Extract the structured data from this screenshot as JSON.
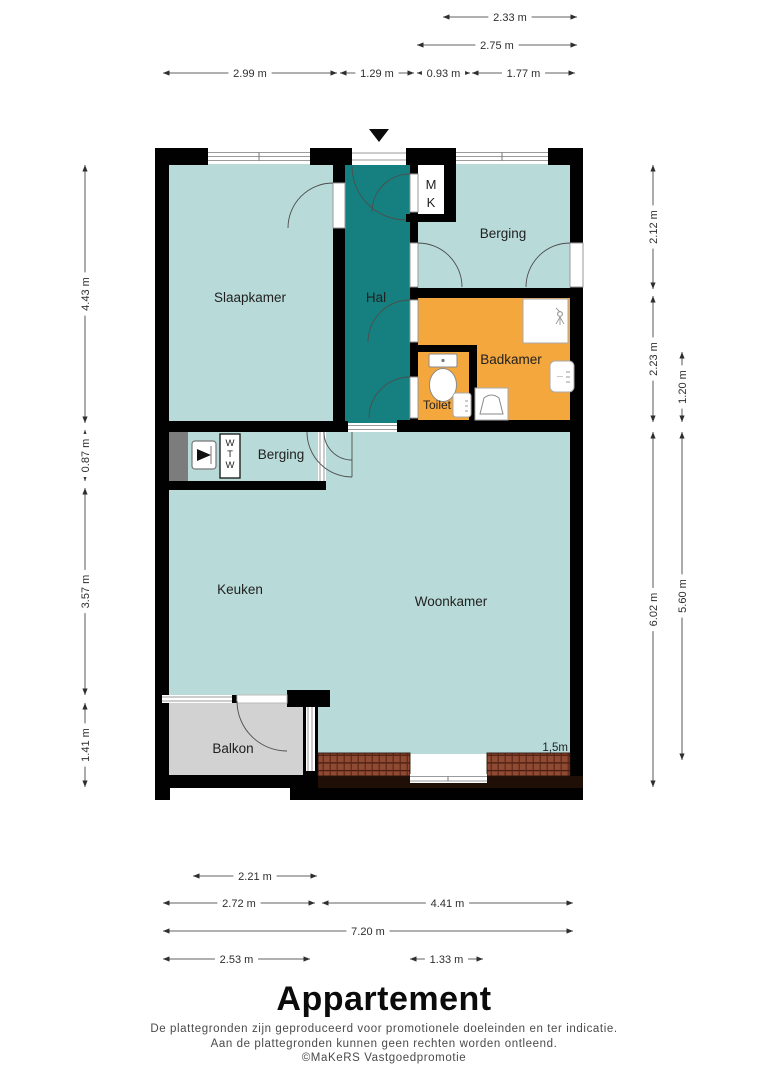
{
  "plan": {
    "rooms": {
      "slaapkamer": "Slaapkamer",
      "hal": "Hal",
      "berging_top": "Berging",
      "badkamer": "Badkamer",
      "toilet": "Toilet",
      "berging_mid": "Berging",
      "keuken": "Keuken",
      "woonkamer": "Woonkamer",
      "balkon": "Balkon"
    },
    "labels": {
      "meterkast": [
        "M",
        "K"
      ],
      "wtw_unit": [
        "W",
        "T",
        "W"
      ],
      "wall_height_marker": "1,5m"
    },
    "colors": {
      "room_fill": "#b8dbd9",
      "hall_fill": "#15807f",
      "bathroom_fill": "#f4a73d",
      "balcony_fill": "#d2d2d2",
      "storage_block": "#7c7c7c",
      "wall": "#010101",
      "brick": "#8e4a33"
    }
  },
  "dimensions": {
    "top": [
      "2.33 m",
      "2.75 m",
      "2.99 m",
      "1.29 m",
      "0.93 m",
      "1.77 m"
    ],
    "left": [
      "4.43 m",
      "0.87 m",
      "3.57 m",
      "1.41 m"
    ],
    "right": [
      "2.12 m",
      "2.23 m",
      "1.20 m",
      "6.02 m",
      "5.60 m"
    ],
    "bottom": [
      "2.21 m",
      "2.72 m",
      "4.41 m",
      "7.20 m",
      "2.53 m",
      "1.33 m"
    ]
  },
  "footer": {
    "title": "Appartement",
    "disclaimer_line1": "De plattegronden zijn geproduceerd voor promotionele doeleinden en ter indicatie.",
    "disclaimer_line2": "Aan de plattegronden kunnen geen rechten worden ontleend.",
    "credit": "©MaKeRS Vastgoedpromotie"
  }
}
